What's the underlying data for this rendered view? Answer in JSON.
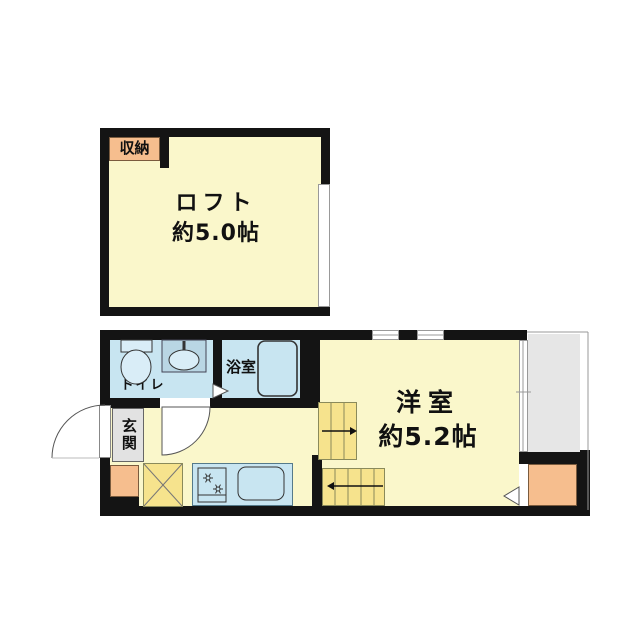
{
  "loft": {
    "label": "ロフト",
    "area": "約5.0帖",
    "closet_label": "収納"
  },
  "main_floor": {
    "room_label": "洋室",
    "room_area": "約5.2帖",
    "toilet_label": "トイレ",
    "bath_label": "浴室",
    "entrance_label": "玄関"
  },
  "icons": {
    "toilet": "toilet-icon",
    "wash_basin": "wash-basin-icon",
    "bathtub": "bathtub-icon",
    "stove_burners": "stove-icon",
    "kitchen_sink": "kitchen-sink-icon",
    "washer_space": "washer-space-x-icon",
    "stairs_up_arrow": "stairs-upper-arrow",
    "stairs_down_arrow": "stairs-lower-arrow",
    "door_swing": "door-swing-arc"
  },
  "colors": {
    "wall": "#141414",
    "floor": "#FAF7CB",
    "wet": "#C8E5F1",
    "stairs": "#F6E38D",
    "accent": "#F6BE8E",
    "entrance_gray": "#E2E2E2",
    "balcony_gray": "#E6E6E6"
  }
}
